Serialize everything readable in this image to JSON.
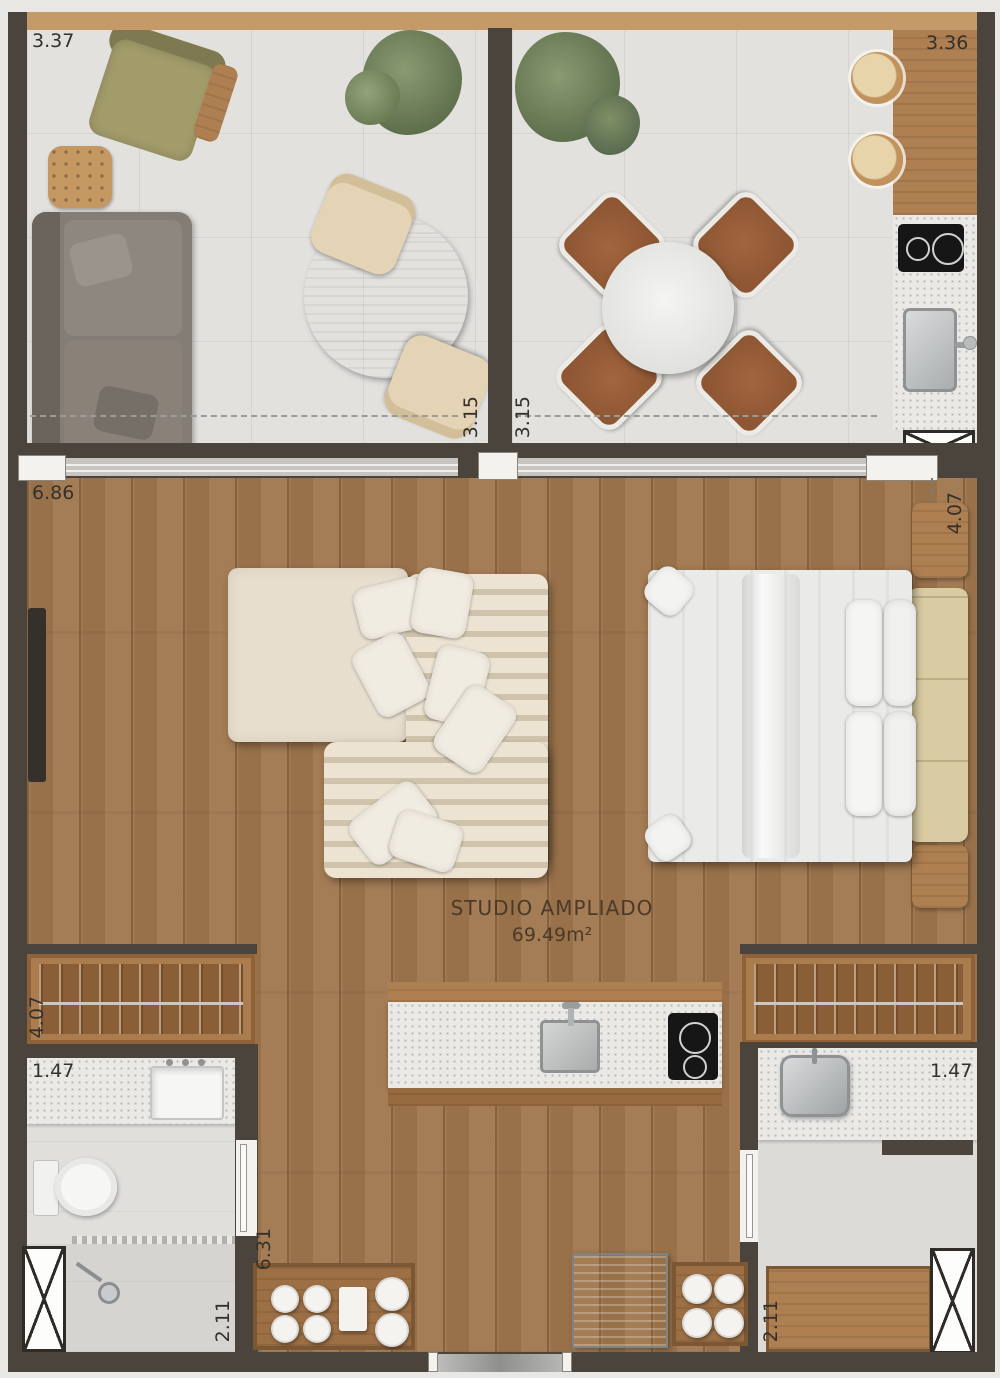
{
  "title": {
    "name": "STUDIO AMPLIADO",
    "area": "69.49m²"
  },
  "dims": {
    "balcony_width": "3.37",
    "dining_width": "3.36",
    "balcony_depth": "3.15",
    "dining_depth": "3.15",
    "studio_width": "6.86",
    "studio_depth": "4.07",
    "closet_length": "4.07",
    "bathroom_width": "1.47",
    "bathroom_length": "2.11",
    "service_width": "1.47",
    "service_length": "2.11",
    "lower_span": "6.31"
  }
}
